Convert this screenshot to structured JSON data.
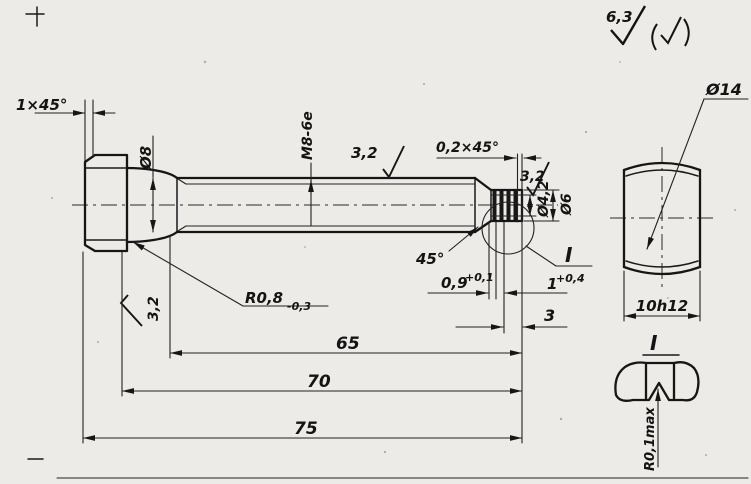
{
  "drawing": {
    "surface_finish": {
      "general_value": "6,3"
    },
    "labels": {
      "head_chamfer": "1×45°",
      "shank_diameter": "Ø8",
      "thread_spec": "M8-6e",
      "roughness_shank": "3,2",
      "tip_chamfer": "0,2×45°",
      "roughness_tip": "3,2",
      "roughness_head_face": "3,2",
      "neck_diameter": "Ø4,2",
      "tip_diameter": "Ø6",
      "runout_angle": "45°",
      "groove_width_base": "0,9",
      "groove_width_tol": "+0,1",
      "groove_pitch_base": "1",
      "groove_pitch_tol": "+0,4",
      "tip_land_length": "3",
      "fillet_radius_base": "R0,8",
      "fillet_radius_tol": "-0,3",
      "thread_length": "65",
      "grip_length": "70",
      "overall_length": "75",
      "head_diameter": "Ø14",
      "width_across_flats": "10h12",
      "detail_view_ref": "I",
      "detail_view_title": "I",
      "detail_radius": "R0,1max"
    }
  }
}
